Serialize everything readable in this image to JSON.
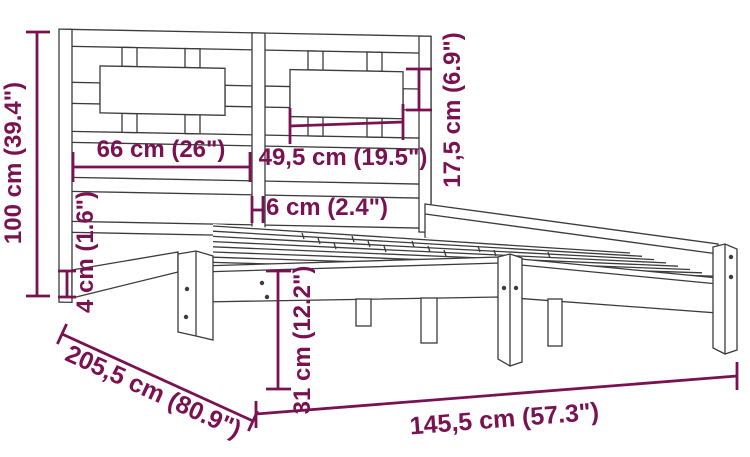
{
  "diagram": {
    "type": "product-dimension-drawing",
    "subject": "wooden bed frame with slatted headboard",
    "colors": {
      "dimension": "#7a1252",
      "outline": "#3b3b3b",
      "background": "#ffffff"
    },
    "dimensions": [
      {
        "id": "total-height",
        "label": "100 cm (39.4\")"
      },
      {
        "id": "headboard-left-section",
        "label": "66 cm (26\")"
      },
      {
        "id": "headboard-right-panel",
        "label": "49,5 cm (19.5\")"
      },
      {
        "id": "panel-height",
        "label": "17,5 cm (6.9\")"
      },
      {
        "id": "center-post-width",
        "label": "6 cm (2.4\")"
      },
      {
        "id": "rail-thickness",
        "label": "4 cm (1.6\")"
      },
      {
        "id": "base-height",
        "label": "31 cm (12.2\")"
      },
      {
        "id": "frame-length",
        "label": "205,5 cm (80.9\")"
      },
      {
        "id": "frame-width",
        "label": "145,5 cm (57.3\")"
      }
    ]
  }
}
